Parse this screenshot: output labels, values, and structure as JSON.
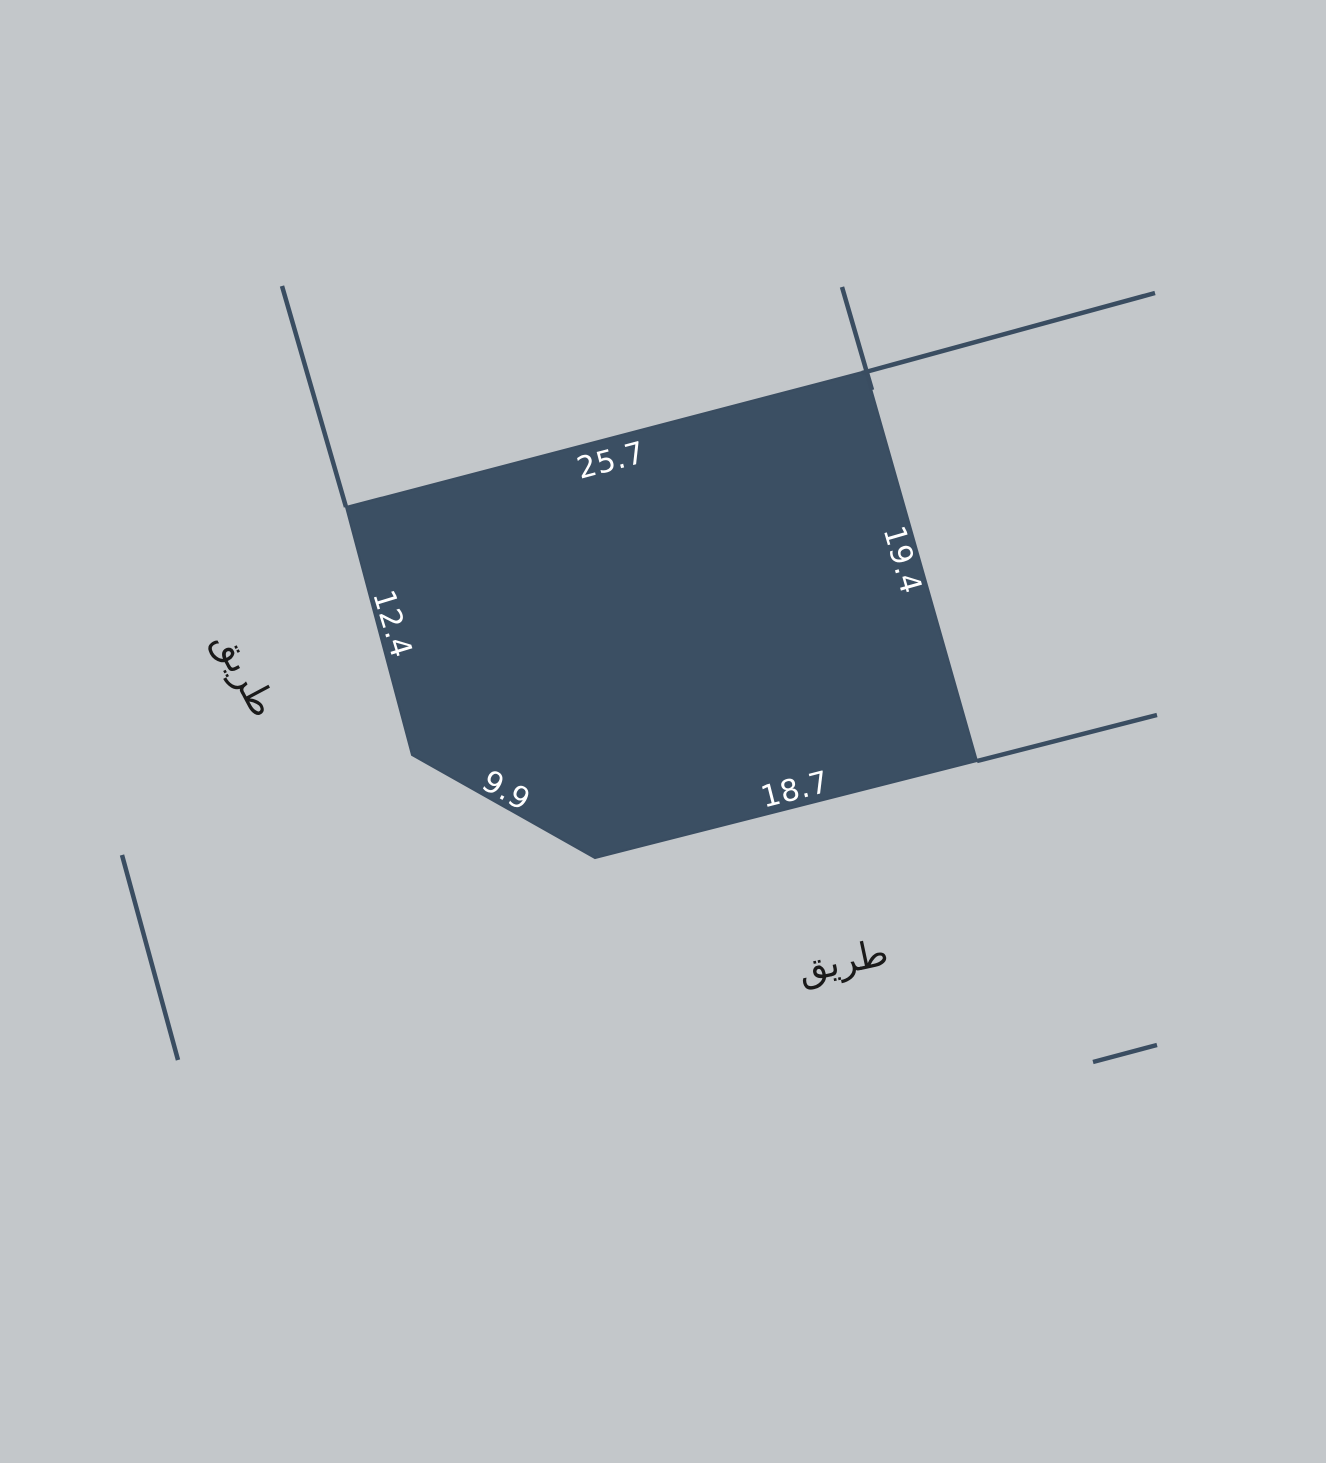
{
  "colors": {
    "background": "#c3c7ca",
    "parcel_fill": "#3b4f63",
    "boundary_line": "#3a4d61",
    "dimension_text": "#ffffff",
    "road_text": "#1a1a1a"
  },
  "map": {
    "parcel": {
      "points": "346,507 866,371 977,761 595,858 412,755",
      "dimension_labels": [
        {
          "value": "25.7",
          "x": 611,
          "y": 461,
          "angle": -14.7
        },
        {
          "value": "19.4",
          "x": 902,
          "y": 560,
          "angle": 74
        },
        {
          "value": "18.7",
          "x": 795,
          "y": 790,
          "angle": -14.2
        },
        {
          "value": "9.9",
          "x": 506,
          "y": 791,
          "angle": 29.4
        },
        {
          "value": "12.4",
          "x": 392,
          "y": 624,
          "angle": 73
        }
      ]
    },
    "boundary_lines": [
      {
        "x1": 282,
        "y1": 286,
        "x2": 346,
        "y2": 507
      },
      {
        "x1": 842,
        "y1": 287,
        "x2": 872,
        "y2": 390
      },
      {
        "x1": 862,
        "y1": 373,
        "x2": 1155,
        "y2": 293
      },
      {
        "x1": 977,
        "y1": 761,
        "x2": 1157,
        "y2": 715
      },
      {
        "x1": 122,
        "y1": 855,
        "x2": 178,
        "y2": 1060
      },
      {
        "x1": 1093,
        "y1": 1062,
        "x2": 1157,
        "y2": 1045
      }
    ],
    "road_labels": [
      {
        "text": "طريق",
        "x": 245,
        "y": 674,
        "angle": 62
      },
      {
        "text": "طريق",
        "x": 843,
        "y": 961,
        "angle": -12
      }
    ]
  }
}
